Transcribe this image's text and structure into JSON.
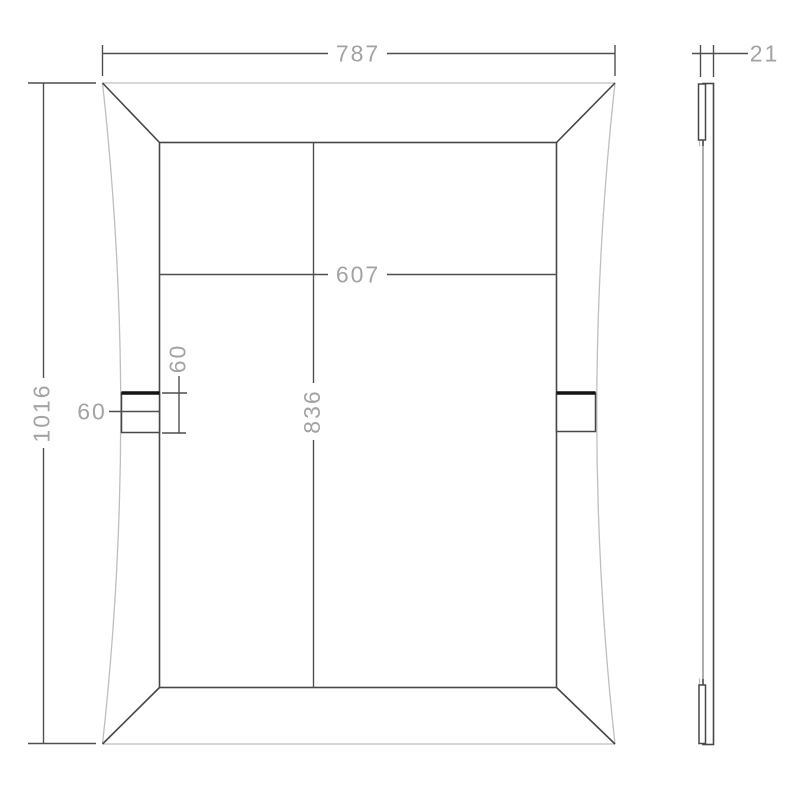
{
  "colors": {
    "background": "#ffffff",
    "line_dark": "#474747",
    "line_light": "#bfbfbf",
    "line_bold": "#141414",
    "dim_line": "#4f4f4f",
    "dim_text": "#a3a3a3"
  },
  "front_view": {
    "dim_width": "787",
    "dim_height": "1016",
    "dim_inner_width": "607",
    "dim_inner_height": "836",
    "dim_bracket_width": "60",
    "dim_bracket_height": "60"
  },
  "side_view": {
    "dim_thickness": "21"
  }
}
